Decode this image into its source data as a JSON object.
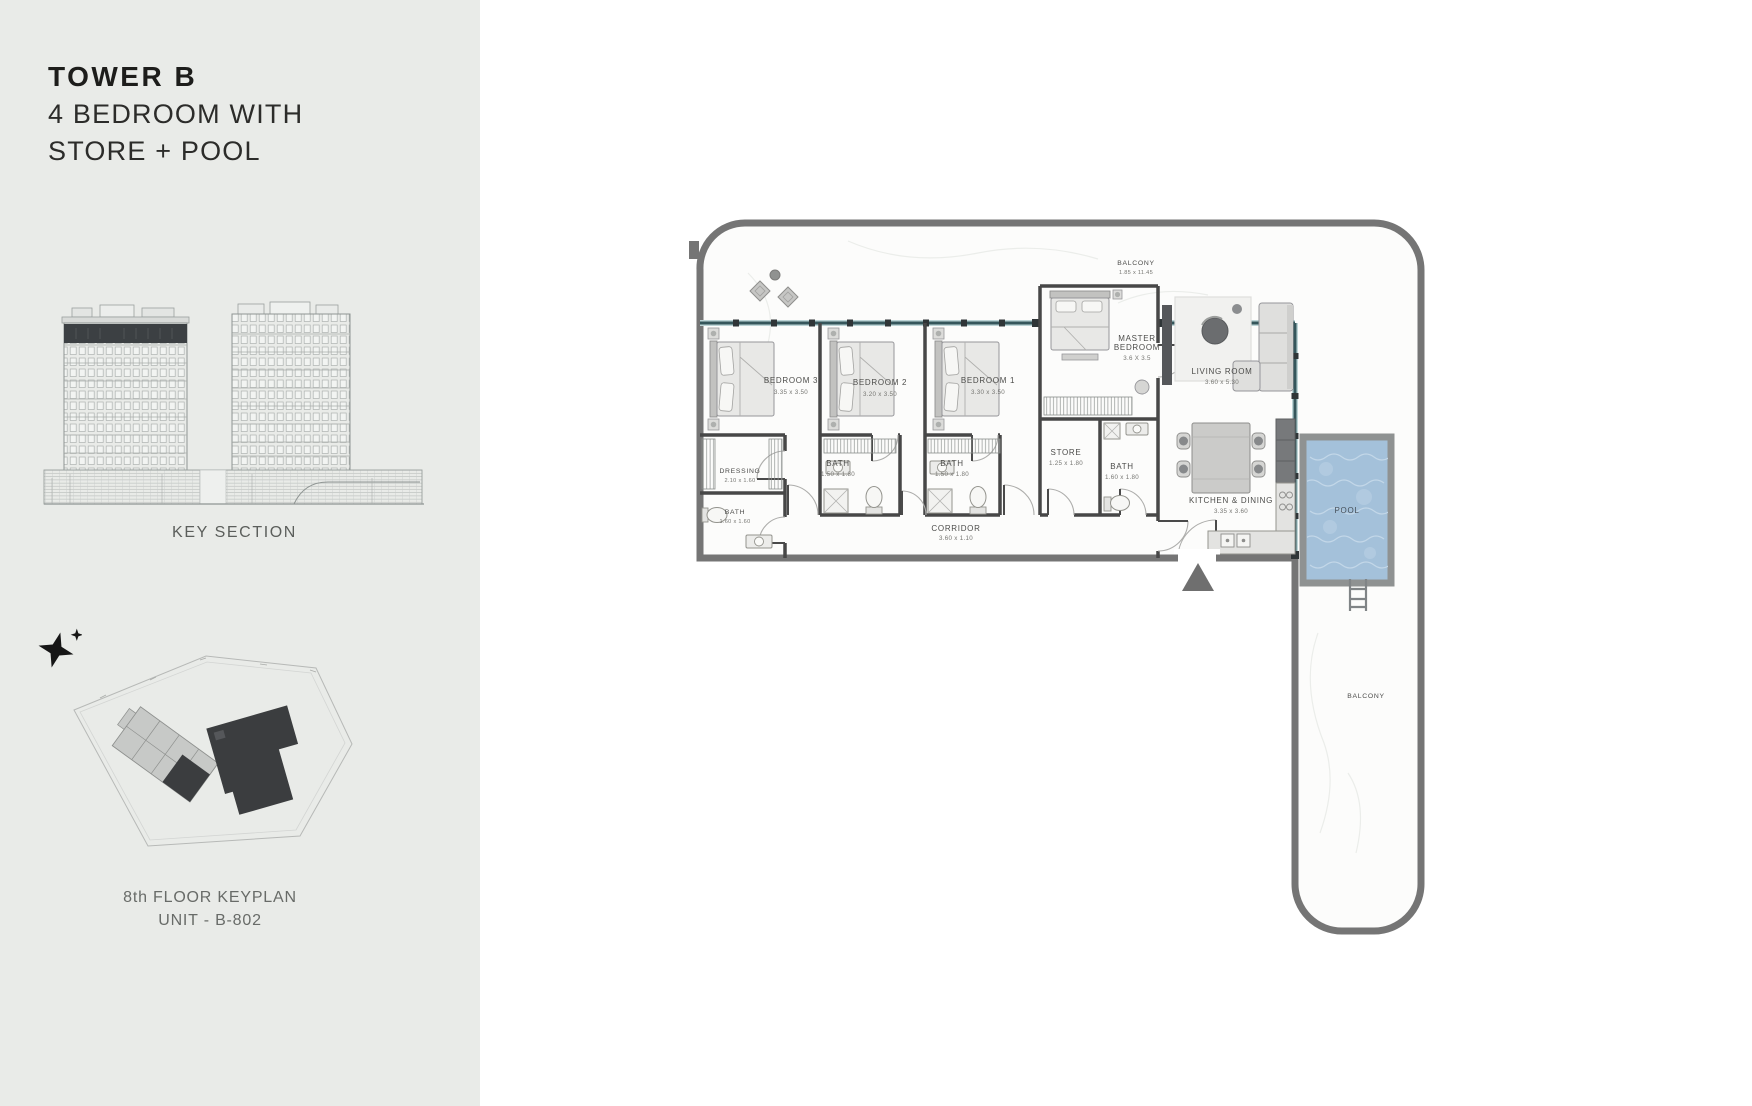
{
  "sidebar": {
    "title_line1": "TOWER B",
    "title_line2": "4 BEDROOM WITH",
    "title_line3": "STORE + POOL",
    "key_section_caption": "KEY SECTION",
    "keyplan_caption_line1": "8th FLOOR KEYPLAN",
    "keyplan_caption_line2": "UNIT - B-802"
  },
  "floorplan": {
    "balcony_top": {
      "name": "BALCONY",
      "dims": "1.85 x 11.45"
    },
    "bedroom3": {
      "name": "BEDROOM 3",
      "dims": "3.35 x 3.50"
    },
    "bedroom2": {
      "name": "BEDROOM 2",
      "dims": "3.20 x 3.50"
    },
    "bedroom1": {
      "name": "BEDROOM 1",
      "dims": "3.30 x 3.50"
    },
    "master_bedroom": {
      "name_line1": "MASTER",
      "name_line2": "BEDROOM",
      "dims": "3.6 X 3.5"
    },
    "living_room": {
      "name": "LIVING ROOM",
      "dims": "3.60 x 5.30"
    },
    "dressing": {
      "name": "DRESSING",
      "dims": "2.10 x 1.60"
    },
    "bath_dressing": {
      "name": "BATH",
      "dims": "1.60 x 1.60"
    },
    "bath_bedroom2": {
      "name": "BATH",
      "dims": "1.50 x 1.80"
    },
    "bath_bedroom1": {
      "name": "BATH",
      "dims": "1.50 x 1.80"
    },
    "store": {
      "name": "STORE",
      "dims": "1.25 x 1.80"
    },
    "bath_master": {
      "name": "BATH",
      "dims": "1.60 x 1.80"
    },
    "kitchen_dining": {
      "name": "KITCHEN & DINING",
      "dims": "3.35 x 3.60"
    },
    "corridor": {
      "name": "CORRIDOR",
      "dims": "3.60 x 1.10"
    },
    "pool": {
      "name": "POOL"
    },
    "balcony_right": {
      "name": "BALCONY"
    }
  },
  "colors": {
    "panel_bg": "#e9ebe8",
    "canvas_bg": "#ffffff",
    "outer_wall": "#757575",
    "inner_wall": "#474747",
    "glass_wall": "#35565b",
    "pool_water": "#a4c1da",
    "title_text": "#1d1d1b",
    "label_text": "#4c4c4a"
  }
}
